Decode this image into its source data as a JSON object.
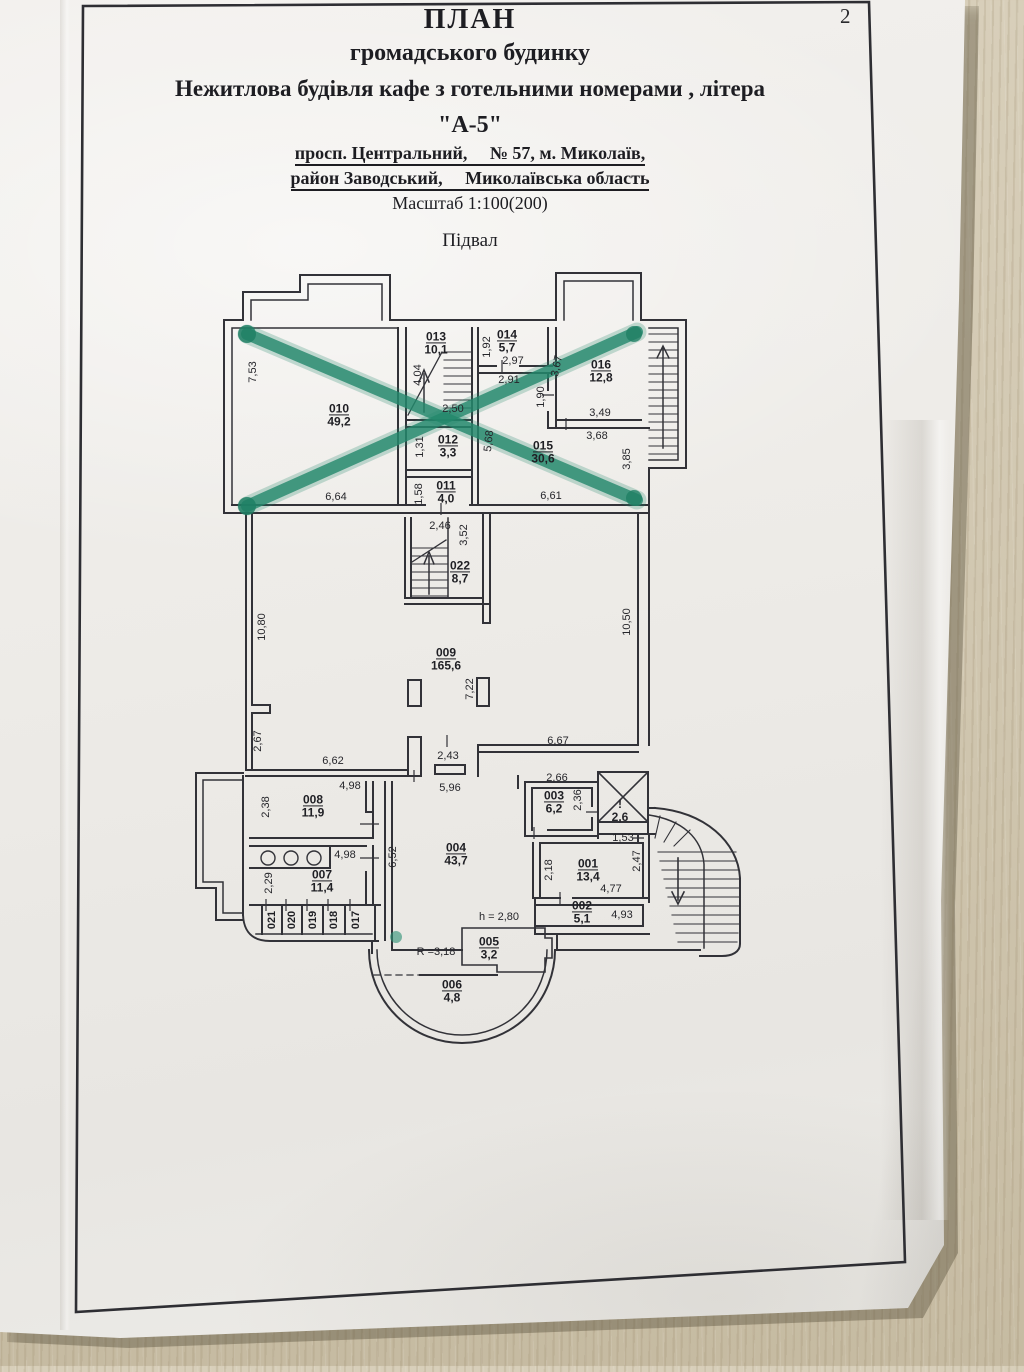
{
  "page": {
    "number": "2"
  },
  "header": {
    "title1": "ПЛАН",
    "title2": "громадського будинку",
    "title3": "Нежитлова будівля кафе з готельними номерами , літера",
    "title4": "\"А-5\"",
    "address1": "просп. Центральний,     № 57, м. Миколаїв,",
    "address2": "район Заводський,     Миколаївська область",
    "scale": "Масштаб 1:100(200)",
    "floor": "Підвал"
  },
  "colors": {
    "paper": "#edebe7",
    "wood": "#cfc5ae",
    "ink": "#2b2b30",
    "marker_green": "#23886c"
  },
  "plan": {
    "rooms": [
      {
        "id": "010",
        "area": "49,2",
        "x": 339,
        "y": 415
      },
      {
        "id": "013",
        "area": "10,1",
        "x": 436,
        "y": 343
      },
      {
        "id": "014",
        "area": "5,7",
        "x": 507,
        "y": 341
      },
      {
        "id": "016",
        "area": "12,8",
        "x": 601,
        "y": 371
      },
      {
        "id": "012",
        "area": "3,3",
        "x": 448,
        "y": 446
      },
      {
        "id": "011",
        "area": "4,0",
        "x": 446,
        "y": 492
      },
      {
        "id": "015",
        "area": "30,6",
        "x": 543,
        "y": 452
      },
      {
        "id": "022",
        "area": "8,7",
        "x": 460,
        "y": 572
      },
      {
        "id": "009",
        "area": "165,6",
        "x": 446,
        "y": 659
      },
      {
        "id": "008",
        "area": "11,9",
        "x": 313,
        "y": 806
      },
      {
        "id": "007",
        "area": "11,4",
        "x": 322,
        "y": 881
      },
      {
        "id": "004",
        "area": "43,7",
        "x": 456,
        "y": 854
      },
      {
        "id": "003",
        "area": "6,2",
        "x": 554,
        "y": 802
      },
      {
        "id": "001",
        "area": "13,4",
        "x": 588,
        "y": 870
      },
      {
        "id": "002",
        "area": "5,1",
        "x": 582,
        "y": 912
      },
      {
        "id": "005",
        "area": "3,2",
        "x": 489,
        "y": 948
      },
      {
        "id": "006",
        "area": "4,8",
        "x": 452,
        "y": 991
      }
    ],
    "cabins": [
      {
        "id": "021",
        "x": 272,
        "y": 920
      },
      {
        "id": "020",
        "x": 292,
        "y": 920
      },
      {
        "id": "019",
        "x": 313,
        "y": 920
      },
      {
        "id": "018",
        "x": 334,
        "y": 920
      },
      {
        "id": "017",
        "x": 356,
        "y": 920
      }
    ],
    "dims": [
      {
        "t": "7,53",
        "x": 253,
        "y": 372,
        "r": -90
      },
      {
        "t": "6,64",
        "x": 336,
        "y": 497
      },
      {
        "t": "4,04",
        "x": 418,
        "y": 375,
        "r": -90
      },
      {
        "t": "2,50",
        "x": 453,
        "y": 409
      },
      {
        "t": "1,92",
        "x": 487,
        "y": 347,
        "r": -90
      },
      {
        "t": "2,97",
        "x": 513,
        "y": 361
      },
      {
        "t": "2,91",
        "x": 509,
        "y": 380
      },
      {
        "t": "3,67",
        "x": 557,
        "y": 366,
        "r": -78
      },
      {
        "t": "1,90",
        "x": 541,
        "y": 397,
        "r": -90
      },
      {
        "t": "3,49",
        "x": 600,
        "y": 413
      },
      {
        "t": "3,68",
        "x": 597,
        "y": 436
      },
      {
        "t": "3,85",
        "x": 627,
        "y": 459,
        "r": -90
      },
      {
        "t": "1,31",
        "x": 420,
        "y": 447,
        "r": -90
      },
      {
        "t": "1,58",
        "x": 419,
        "y": 494,
        "r": -90
      },
      {
        "t": "5,68",
        "x": 489,
        "y": 441,
        "r": -84
      },
      {
        "t": "6,61",
        "x": 551,
        "y": 496
      },
      {
        "t": "2,46",
        "x": 440,
        "y": 526
      },
      {
        "t": "3,52",
        "x": 464,
        "y": 535,
        "r": -90
      },
      {
        "t": "10,80",
        "x": 262,
        "y": 627,
        "r": -90
      },
      {
        "t": "10,50",
        "x": 627,
        "y": 622,
        "r": -90
      },
      {
        "t": "7,22",
        "x": 470,
        "y": 689,
        "r": -90
      },
      {
        "t": "2,67",
        "x": 258,
        "y": 741,
        "r": -90
      },
      {
        "t": "6,62",
        "x": 333,
        "y": 761
      },
      {
        "t": "2,43",
        "x": 448,
        "y": 756
      },
      {
        "t": "5,96",
        "x": 450,
        "y": 788
      },
      {
        "t": "6,67",
        "x": 558,
        "y": 741
      },
      {
        "t": "4,98",
        "x": 350,
        "y": 786
      },
      {
        "t": "2,38",
        "x": 266,
        "y": 807,
        "r": -90
      },
      {
        "t": "4,98",
        "x": 345,
        "y": 855
      },
      {
        "t": "2,29",
        "x": 269,
        "y": 883,
        "r": -90
      },
      {
        "t": "6,52",
        "x": 393,
        "y": 857,
        "r": -90
      },
      {
        "t": "2,66",
        "x": 557,
        "y": 778
      },
      {
        "t": "2,36",
        "x": 578,
        "y": 800,
        "r": -90
      },
      {
        "t": "1,53",
        "x": 623,
        "y": 838
      },
      {
        "t": "2,18",
        "x": 549,
        "y": 870,
        "r": -90
      },
      {
        "t": "2,47",
        "x": 637,
        "y": 861,
        "r": -90
      },
      {
        "t": "4,77",
        "x": 611,
        "y": 889
      },
      {
        "t": "4,93",
        "x": 622,
        "y": 915
      },
      {
        "t": "h = 2,80",
        "x": 499,
        "y": 917
      },
      {
        "t": "R =3,18",
        "x": 436,
        "y": 952
      },
      {
        "t": "!",
        "x": 620,
        "y": 804,
        "b": true
      },
      {
        "t": "2,6",
        "x": 620,
        "y": 817,
        "b": true
      }
    ]
  }
}
